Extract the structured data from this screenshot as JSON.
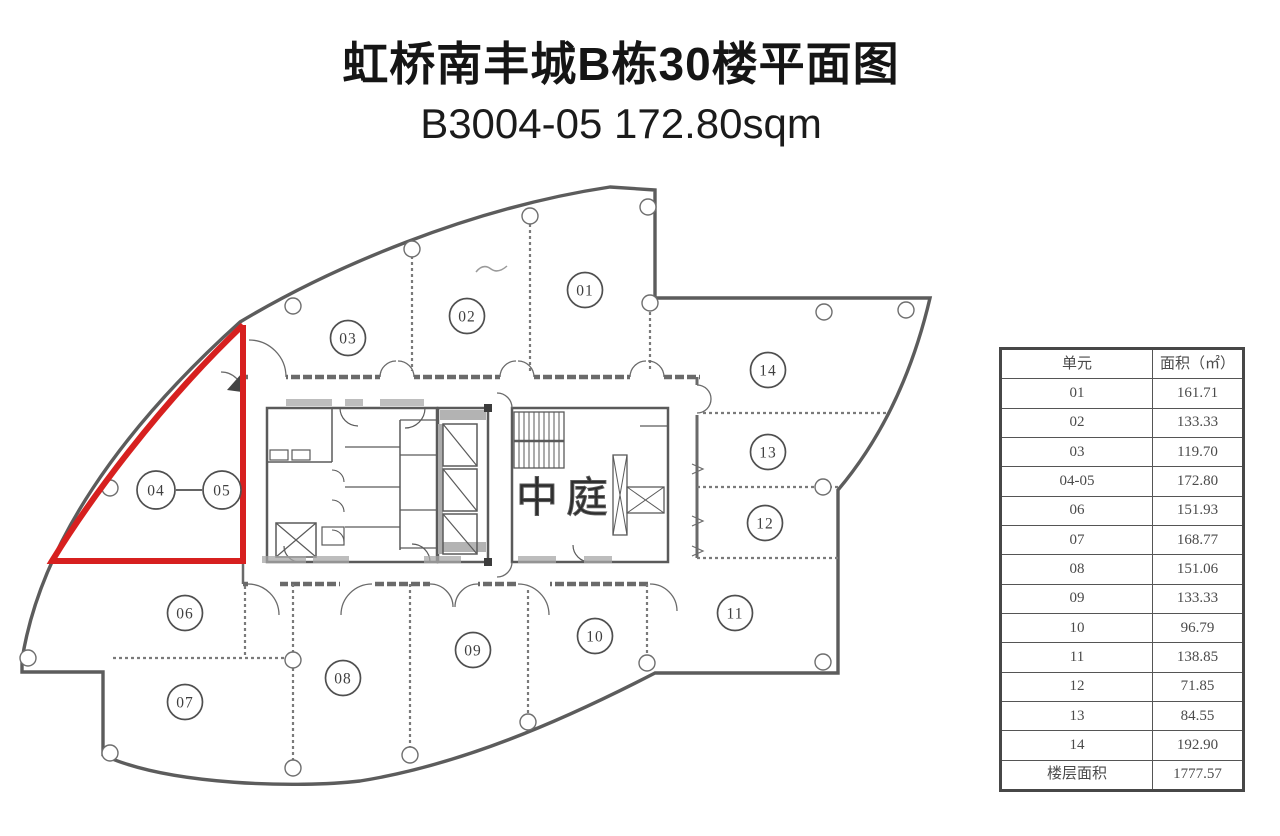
{
  "page": {
    "title_line1": "虹桥南丰城B栋30楼平面图",
    "title_line2": "B3004-05 172.80sqm"
  },
  "plan": {
    "atrium_label": "中庭",
    "highlighted_unit": "04-05",
    "highlight_color": "#d7201f",
    "bubbles": [
      {
        "label": "01"
      },
      {
        "label": "02"
      },
      {
        "label": "03"
      },
      {
        "label": "04"
      },
      {
        "label": "05"
      },
      {
        "label": "06"
      },
      {
        "label": "07"
      },
      {
        "label": "08"
      },
      {
        "label": "09"
      },
      {
        "label": "10"
      },
      {
        "label": "11"
      },
      {
        "label": "12"
      },
      {
        "label": "13"
      },
      {
        "label": "14"
      }
    ]
  },
  "table": {
    "headers": [
      "单元",
      "面积（㎡）"
    ],
    "rows": [
      {
        "unit": "01",
        "area": "161.71"
      },
      {
        "unit": "02",
        "area": "133.33"
      },
      {
        "unit": "03",
        "area": "119.70"
      },
      {
        "unit": "04-05",
        "area": "172.80"
      },
      {
        "unit": "06",
        "area": "151.93"
      },
      {
        "unit": "07",
        "area": "168.77"
      },
      {
        "unit": "08",
        "area": "151.06"
      },
      {
        "unit": "09",
        "area": "133.33"
      },
      {
        "unit": "10",
        "area": "96.79"
      },
      {
        "unit": "11",
        "area": "138.85"
      },
      {
        "unit": "12",
        "area": "71.85"
      },
      {
        "unit": "13",
        "area": "84.55"
      },
      {
        "unit": "14",
        "area": "192.90"
      },
      {
        "unit": "楼层面积",
        "area": "1777.57"
      }
    ]
  }
}
